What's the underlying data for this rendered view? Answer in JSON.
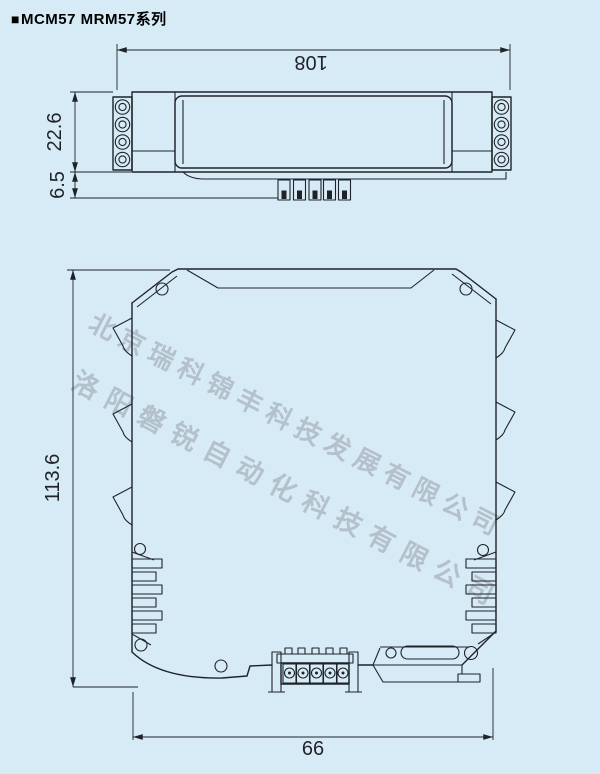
{
  "header": {
    "bullet": "■",
    "title": "MCM57 MRM57系列"
  },
  "watermarks": {
    "line1": "北京瑞科锦丰科技发展有限公司",
    "line2": "洛阳磐锐自动化科技有限公司"
  },
  "top_view": {
    "label": "module top view",
    "dim_width": "108",
    "dim_body_depth": "22.6",
    "dim_pin_depth": "6.5"
  },
  "front_view": {
    "label": "module front view",
    "dim_height": "113.6",
    "dim_width": "66"
  },
  "colors": {
    "background": "#d7ebf7",
    "line": "#1f2328",
    "watermark": "#a7b1b9"
  }
}
